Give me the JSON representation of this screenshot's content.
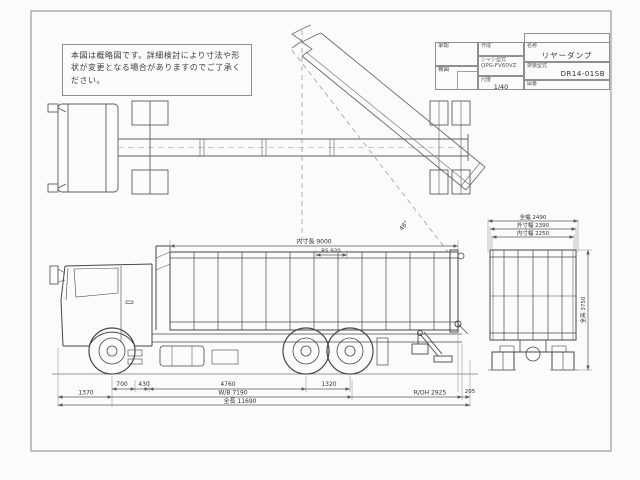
{
  "note": {
    "text": "本図は概略図です。詳細検討により寸法や形状が変更となる場合がありますのでご了承ください。"
  },
  "title_block": {
    "approve_label": "承認",
    "check_label": "検図",
    "prepared_label": "作成",
    "chassis_label": "シャシ型式",
    "chassis_value": "QPG-FV60VZ",
    "scale_label": "尺度",
    "scale_value": "1/40",
    "name_label": "名称",
    "name_value": "リヤーダンプ",
    "body_label": "架装型式",
    "body_value": "DR14-01SB",
    "dwg_no_label": "図番",
    "dwg_no_value": ""
  },
  "dimensions": {
    "top_view": {
      "dump_angle": "48°"
    },
    "side_view": {
      "inner_length": "内寸長 9000",
      "d920": "RS 920",
      "front_overhang": "1370",
      "d700": "700",
      "d430": "430",
      "d4760": "4760",
      "tandem_spread": "1320",
      "wheelbase": "W/B 7190",
      "rear_overhang": "R/OH 2925",
      "d205": "205",
      "overall_length": "全長 11690"
    },
    "rear_view": {
      "overall_width": "全幅 2490",
      "outer_width": "外寸幅 2390",
      "inner_width": "内寸幅 2250",
      "overall_height": "全高 3750"
    }
  },
  "colors": {
    "ink": "#4a4a4a",
    "frame": "#9a9a9a",
    "paper": "#fbfbfa"
  }
}
